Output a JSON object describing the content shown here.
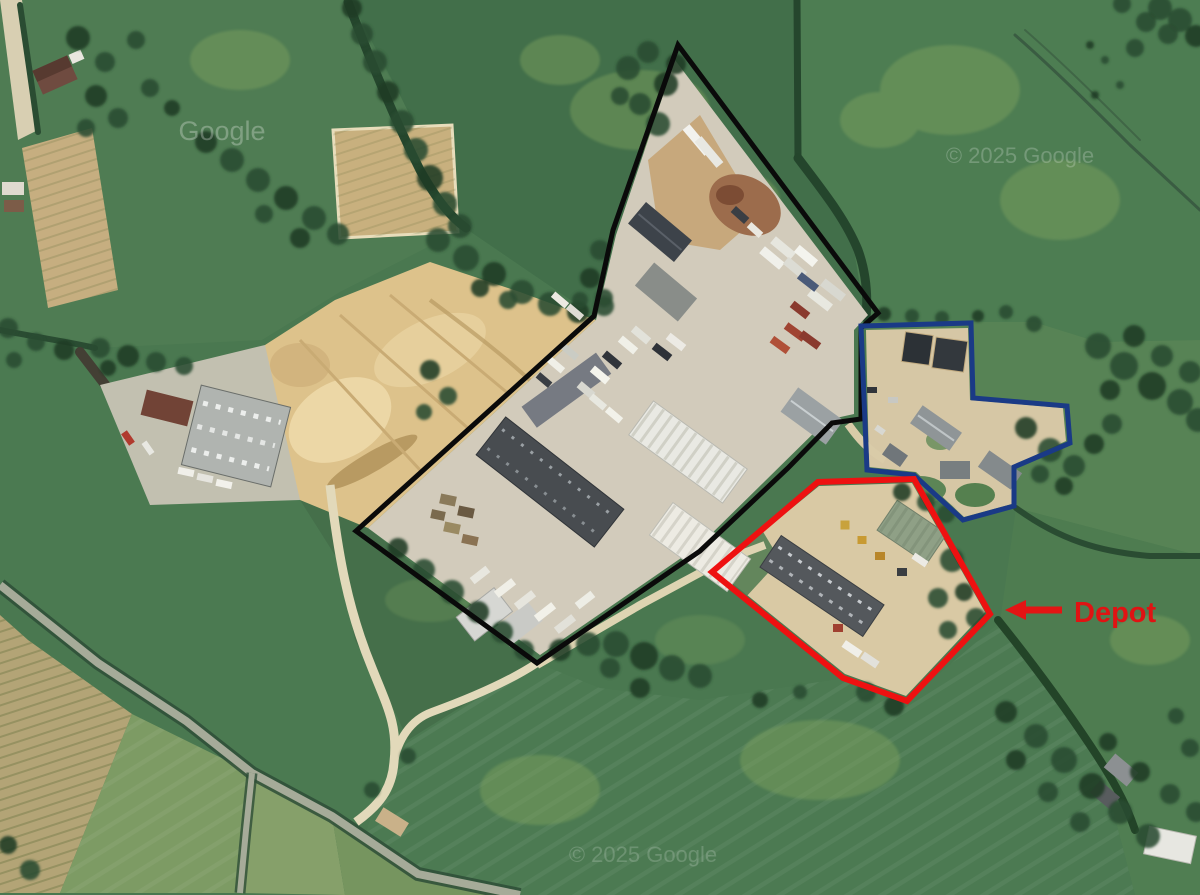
{
  "map": {
    "kind": "aerial-satellite-imagery",
    "scene": "rural fields with industrial estate, sand quarry, access roads"
  },
  "watermarks": [
    {
      "name": "google-watermark-topleft",
      "text": "Google",
      "x": 222,
      "y": 140,
      "size": 27,
      "opacity": 0.28
    },
    {
      "name": "google-watermark-topright",
      "text": "© 2025 Google",
      "x": 1020,
      "y": 163,
      "size": 22,
      "opacity": 0.22
    },
    {
      "name": "google-watermark-bottom",
      "text": "© 2025 Google",
      "x": 643,
      "y": 862,
      "size": 22,
      "opacity": 0.18
    }
  ],
  "annotations": {
    "polygons": [
      {
        "name": "site-boundary-black",
        "color": "#0a0a0a",
        "width": 5,
        "points": [
          [
            678,
            45
          ],
          [
            878,
            313
          ],
          [
            861,
            328
          ],
          [
            861,
            419
          ],
          [
            832,
            423
          ],
          [
            788,
            468
          ],
          [
            700,
            551
          ],
          [
            537,
            663
          ],
          [
            356,
            531
          ],
          [
            594,
            316
          ],
          [
            613,
            230
          ]
        ]
      },
      {
        "name": "parcel-outline-blue",
        "color": "#1a3a86",
        "width": 5,
        "points": [
          [
            861,
            326
          ],
          [
            971,
            323
          ],
          [
            973,
            398
          ],
          [
            1067,
            406
          ],
          [
            1070,
            443
          ],
          [
            1014,
            467
          ],
          [
            1014,
            506
          ],
          [
            963,
            520
          ],
          [
            914,
            475
          ],
          [
            867,
            470
          ]
        ]
      },
      {
        "name": "depot-outline-red",
        "color": "#ee1111",
        "width": 6,
        "points": [
          [
            712,
            572
          ],
          [
            818,
            482
          ],
          [
            914,
            479
          ],
          [
            990,
            614
          ],
          [
            907,
            701
          ],
          [
            843,
            678
          ]
        ]
      }
    ],
    "arrow": {
      "name": "depot-arrow",
      "color": "#e41414",
      "width": 7,
      "line": [
        [
          1062,
          610
        ],
        [
          1024,
          610
        ]
      ],
      "head": [
        [
          1005,
          610
        ],
        [
          1026,
          600
        ],
        [
          1026,
          620
        ]
      ]
    },
    "label": {
      "name": "depot-label",
      "text": "Depot",
      "color": "#e01313",
      "x": 1074,
      "y": 622,
      "size": 29,
      "weight": "bold"
    }
  },
  "colors": {
    "annotation_black": "#0a0a0a",
    "annotation_blue": "#1a3a86",
    "annotation_red": "#ee1111",
    "depot_label_red": "#e01313",
    "watermark": "#ffffff"
  }
}
